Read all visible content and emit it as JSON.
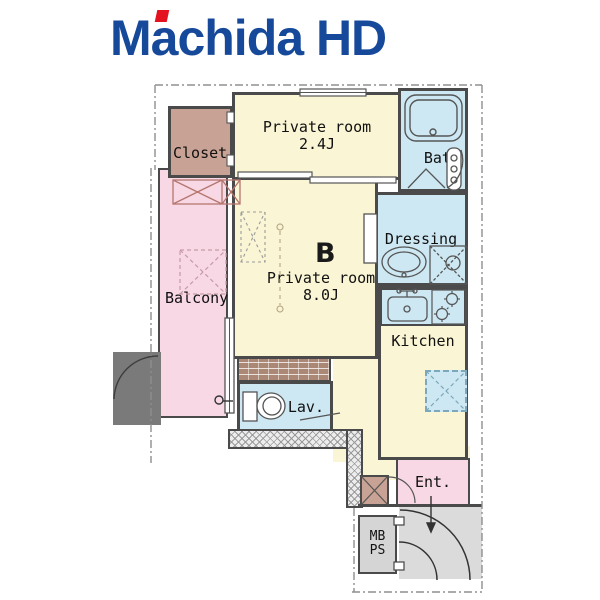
{
  "logo": {
    "brand": "Machida HD",
    "brand_color": "#17499B",
    "accent_color": "#E4121F"
  },
  "plan": {
    "rooms": {
      "closet": {
        "label": "Closet"
      },
      "private_room_small": {
        "label": "Private room",
        "size": "2.4J"
      },
      "bath": {
        "label": "Bath"
      },
      "dressing": {
        "label": "Dressing"
      },
      "kitchen": {
        "label": "Kitchen"
      },
      "room_b": {
        "unit": "B",
        "label": "Private room",
        "size": "8.0J"
      },
      "balcony": {
        "label": "Balcony"
      },
      "lavatory": {
        "label": "Lav."
      },
      "entrance": {
        "label": "Ent."
      },
      "meter_pipe_space": {
        "line1": "MB",
        "line2": "PS"
      }
    },
    "colors": {
      "room_fill": "#FAF5D5",
      "wet_area_fill": "#CDE8F2",
      "balcony_fill": "#F8D8E4",
      "closet_fill": "#C8A294",
      "wall": "#4A4A4A",
      "corridor": "#DBDBDB"
    }
  }
}
